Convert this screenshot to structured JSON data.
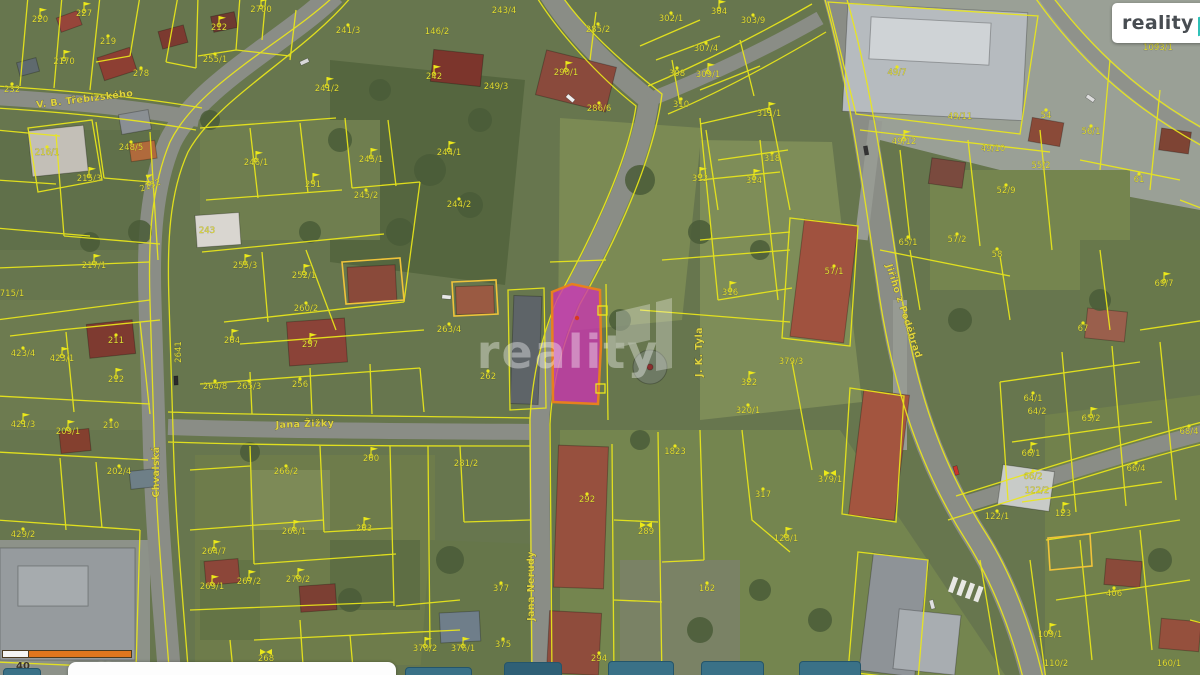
{
  "logo": {
    "brand": "reality",
    "brand_suffix": "11"
  },
  "scale_bar": {
    "left_label": "40",
    "right_label": "50 m"
  },
  "map": {
    "watermark": "reality",
    "colors": {
      "boundary": "#ebe81a",
      "parcel_label": "#e3de34",
      "street_label": "#e0d43e",
      "highlight_fill": "#c837ae",
      "highlight_stroke": "#e7801e",
      "logo_teal": "#2fc1b8",
      "scale_orange": "#e0761e"
    },
    "streets": [
      {
        "label": "V. B. Třebízského",
        "x": 85,
        "y": 102,
        "rot": -7
      },
      {
        "label": "Jana Žižky",
        "x": 305,
        "y": 427,
        "rot": -2
      },
      {
        "label": "Jana Nerudy",
        "x": 534,
        "y": 586,
        "rot": -90
      },
      {
        "label": "J. K. Tyla",
        "x": 702,
        "y": 352,
        "rot": -90
      },
      {
        "label": "Jiřího z Poděbrad",
        "x": 901,
        "y": 312,
        "rot": 72
      },
      {
        "label": "Chvalská",
        "x": 159,
        "y": 472,
        "rot": -90
      }
    ],
    "parcels": [
      {
        "id": "220",
        "x": 40,
        "y": 22,
        "m": "flag"
      },
      {
        "id": "227",
        "x": 84,
        "y": 16,
        "m": "flag"
      },
      {
        "id": "219",
        "x": 108,
        "y": 44,
        "m": "dot"
      },
      {
        "id": "2170",
        "x": 64,
        "y": 64,
        "m": "flag"
      },
      {
        "id": "232",
        "x": 12,
        "y": 92,
        "m": "dot"
      },
      {
        "id": "278",
        "x": 141,
        "y": 76,
        "m": "dot"
      },
      {
        "id": "212",
        "x": 219,
        "y": 30,
        "m": "flag"
      },
      {
        "id": "255/1",
        "x": 215,
        "y": 62,
        "m": "dot"
      },
      {
        "id": "2700",
        "x": 261,
        "y": 12,
        "m": "flag"
      },
      {
        "id": "241/3",
        "x": 348,
        "y": 33,
        "m": "dot"
      },
      {
        "id": "241/2",
        "x": 327,
        "y": 91,
        "m": "flag"
      },
      {
        "id": "216/1",
        "x": 47,
        "y": 155,
        "m": "dot"
      },
      {
        "id": "248/5",
        "x": 131,
        "y": 150,
        "m": "dot"
      },
      {
        "id": "215/3",
        "x": 89,
        "y": 181,
        "m": "flag"
      },
      {
        "id": "2152",
        "x": 151,
        "y": 188,
        "m": "flag",
        "rot": -20
      },
      {
        "id": "217/1",
        "x": 94,
        "y": 268,
        "m": "flag"
      },
      {
        "id": "246/1",
        "x": 256,
        "y": 165,
        "m": "flag"
      },
      {
        "id": "251",
        "x": 313,
        "y": 187,
        "m": "flag"
      },
      {
        "id": "245/1",
        "x": 371,
        "y": 162,
        "m": "flag"
      },
      {
        "id": "245/2",
        "x": 366,
        "y": 198,
        "m": "dot"
      },
      {
        "id": "243",
        "x": 207,
        "y": 233,
        "m": "none"
      },
      {
        "id": "255/3",
        "x": 245,
        "y": 268,
        "m": "flag"
      },
      {
        "id": "252/1",
        "x": 304,
        "y": 278,
        "m": "flag"
      },
      {
        "id": "715/1",
        "x": 12,
        "y": 296,
        "m": "none"
      },
      {
        "id": "243/4",
        "x": 504,
        "y": 13,
        "m": "none"
      },
      {
        "id": "146/2",
        "x": 437,
        "y": 34,
        "m": "none"
      },
      {
        "id": "242",
        "x": 434,
        "y": 79,
        "m": "flag"
      },
      {
        "id": "249/3",
        "x": 496,
        "y": 89,
        "m": "none"
      },
      {
        "id": "244/1",
        "x": 449,
        "y": 155,
        "m": "flag"
      },
      {
        "id": "244/2",
        "x": 459,
        "y": 207,
        "m": "dot"
      },
      {
        "id": "285/2",
        "x": 598,
        "y": 32,
        "m": "dot"
      },
      {
        "id": "290/1",
        "x": 566,
        "y": 75,
        "m": "flag"
      },
      {
        "id": "286/6",
        "x": 599,
        "y": 111,
        "m": "dot"
      },
      {
        "id": "302/1",
        "x": 671,
        "y": 21,
        "m": "dot"
      },
      {
        "id": "304",
        "x": 719,
        "y": 14,
        "m": "flag"
      },
      {
        "id": "303/9",
        "x": 753,
        "y": 23,
        "m": "dot"
      },
      {
        "id": "307/4",
        "x": 706,
        "y": 51,
        "m": "dot"
      },
      {
        "id": "308",
        "x": 677,
        "y": 76,
        "m": "dot"
      },
      {
        "id": "309/1",
        "x": 708,
        "y": 77,
        "m": "flag"
      },
      {
        "id": "310",
        "x": 681,
        "y": 107,
        "m": "dot"
      },
      {
        "id": "311/1",
        "x": 769,
        "y": 116,
        "m": "flag"
      },
      {
        "id": "312",
        "x": 700,
        "y": 181,
        "m": "flag"
      },
      {
        "id": "314",
        "x": 754,
        "y": 183,
        "m": "flag"
      },
      {
        "id": "318",
        "x": 772,
        "y": 161,
        "m": "dot"
      },
      {
        "id": "316",
        "x": 730,
        "y": 295,
        "m": "flag"
      },
      {
        "id": "49/7",
        "x": 897,
        "y": 75,
        "m": "dot"
      },
      {
        "id": "1093/1",
        "x": 1158,
        "y": 50,
        "m": "dot"
      },
      {
        "id": "49/11",
        "x": 960,
        "y": 119,
        "m": "none"
      },
      {
        "id": "49/12",
        "x": 904,
        "y": 144,
        "m": "flag"
      },
      {
        "id": "49/10",
        "x": 993,
        "y": 151,
        "m": "none"
      },
      {
        "id": "54",
        "x": 1046,
        "y": 118,
        "m": "dot"
      },
      {
        "id": "56/1",
        "x": 1091,
        "y": 134,
        "m": "dot"
      },
      {
        "id": "55/2",
        "x": 1041,
        "y": 168,
        "m": "none"
      },
      {
        "id": "52/9",
        "x": 1006,
        "y": 193,
        "m": "dot"
      },
      {
        "id": "57/2",
        "x": 957,
        "y": 242,
        "m": "dot"
      },
      {
        "id": "58",
        "x": 997,
        "y": 257,
        "m": "dot"
      },
      {
        "id": "61",
        "x": 1139,
        "y": 182,
        "m": "dot"
      },
      {
        "id": "57/1",
        "x": 834,
        "y": 274,
        "m": "dot"
      },
      {
        "id": "65/1",
        "x": 908,
        "y": 245,
        "m": "dot"
      },
      {
        "id": "69/7",
        "x": 1164,
        "y": 286,
        "m": "flag"
      },
      {
        "id": "423/4",
        "x": 23,
        "y": 356,
        "m": "dot"
      },
      {
        "id": "423/1",
        "x": 62,
        "y": 361,
        "m": "flag"
      },
      {
        "id": "211",
        "x": 116,
        "y": 343,
        "m": "dot"
      },
      {
        "id": "212",
        "x": 116,
        "y": 382,
        "m": "flag"
      },
      {
        "id": "421/3",
        "x": 23,
        "y": 427,
        "m": "flag"
      },
      {
        "id": "209/1",
        "x": 68,
        "y": 434,
        "m": "flag"
      },
      {
        "id": "210",
        "x": 111,
        "y": 428,
        "m": "dot"
      },
      {
        "id": "202/4",
        "x": 119,
        "y": 474,
        "m": "dot"
      },
      {
        "id": "429/2",
        "x": 23,
        "y": 537,
        "m": "dot"
      },
      {
        "id": "264",
        "x": 232,
        "y": 343,
        "m": "flag"
      },
      {
        "id": "257",
        "x": 310,
        "y": 347,
        "m": "flag"
      },
      {
        "id": "260/2",
        "x": 306,
        "y": 311,
        "m": "dot"
      },
      {
        "id": "2641",
        "x": 181,
        "y": 352,
        "m": "none",
        "rot": -90
      },
      {
        "id": "264/8",
        "x": 215,
        "y": 389,
        "m": "dot"
      },
      {
        "id": "265/3",
        "x": 249,
        "y": 389,
        "m": "dot"
      },
      {
        "id": "256",
        "x": 300,
        "y": 387,
        "m": "dot"
      },
      {
        "id": "266/2",
        "x": 286,
        "y": 474,
        "m": "dot"
      },
      {
        "id": "260",
        "x": 371,
        "y": 461,
        "m": "flag"
      },
      {
        "id": "264/7",
        "x": 214,
        "y": 554,
        "m": "flag"
      },
      {
        "id": "266/1",
        "x": 294,
        "y": 534,
        "m": "flag"
      },
      {
        "id": "263",
        "x": 364,
        "y": 531,
        "m": "flag"
      },
      {
        "id": "269/1",
        "x": 212,
        "y": 589,
        "m": "flag"
      },
      {
        "id": "267/2",
        "x": 249,
        "y": 584,
        "m": "flag"
      },
      {
        "id": "270/2",
        "x": 298,
        "y": 582,
        "m": "flag"
      },
      {
        "id": "268",
        "x": 266,
        "y": 661,
        "m": "bowtie"
      },
      {
        "id": "263/4",
        "x": 449,
        "y": 332,
        "m": "dot"
      },
      {
        "id": "262",
        "x": 488,
        "y": 379,
        "m": "dot"
      },
      {
        "id": "281/2",
        "x": 466,
        "y": 466,
        "m": "none"
      },
      {
        "id": "292",
        "x": 587,
        "y": 502,
        "m": "dot"
      },
      {
        "id": "1823",
        "x": 675,
        "y": 454,
        "m": "dot"
      },
      {
        "id": "289",
        "x": 646,
        "y": 534,
        "m": "bowtie"
      },
      {
        "id": "294",
        "x": 599,
        "y": 661,
        "m": "dot"
      },
      {
        "id": "162",
        "x": 707,
        "y": 591,
        "m": "dot"
      },
      {
        "id": "370/2",
        "x": 425,
        "y": 651,
        "m": "flag"
      },
      {
        "id": "376/1",
        "x": 463,
        "y": 651,
        "m": "flag"
      },
      {
        "id": "375",
        "x": 503,
        "y": 647,
        "m": "dot"
      },
      {
        "id": "377",
        "x": 501,
        "y": 591,
        "m": "dot"
      },
      {
        "id": "322",
        "x": 749,
        "y": 385,
        "m": "flag"
      },
      {
        "id": "320/1",
        "x": 748,
        "y": 413,
        "m": "dot"
      },
      {
        "id": "317",
        "x": 763,
        "y": 497,
        "m": "dot"
      },
      {
        "id": "128/1",
        "x": 786,
        "y": 541,
        "m": "flag"
      },
      {
        "id": "379/3",
        "x": 791,
        "y": 364,
        "m": "none"
      },
      {
        "id": "379/1",
        "x": 830,
        "y": 482,
        "m": "bowtie"
      },
      {
        "id": "67",
        "x": 1083,
        "y": 331,
        "m": "dot"
      },
      {
        "id": "64/1",
        "x": 1033,
        "y": 401,
        "m": "dot"
      },
      {
        "id": "64/2",
        "x": 1037,
        "y": 414,
        "m": "none"
      },
      {
        "id": "65/2",
        "x": 1091,
        "y": 421,
        "m": "flag"
      },
      {
        "id": "66/1",
        "x": 1031,
        "y": 456,
        "m": "flag"
      },
      {
        "id": "66/2",
        "x": 1033,
        "y": 479,
        "m": "dot"
      },
      {
        "id": "122/2",
        "x": 1037,
        "y": 493,
        "m": "none"
      },
      {
        "id": "66/4",
        "x": 1136,
        "y": 471,
        "m": "dot"
      },
      {
        "id": "68/4",
        "x": 1189,
        "y": 434,
        "m": "dot"
      },
      {
        "id": "122/1",
        "x": 997,
        "y": 519,
        "m": "dot"
      },
      {
        "id": "123",
        "x": 1063,
        "y": 516,
        "m": "flag"
      },
      {
        "id": "406",
        "x": 1114,
        "y": 596,
        "m": "dot"
      },
      {
        "id": "109/1",
        "x": 1050,
        "y": 637,
        "m": "flag"
      },
      {
        "id": "110/2",
        "x": 1056,
        "y": 666,
        "m": "none"
      },
      {
        "id": "160/1",
        "x": 1169,
        "y": 666,
        "m": "none"
      }
    ]
  }
}
